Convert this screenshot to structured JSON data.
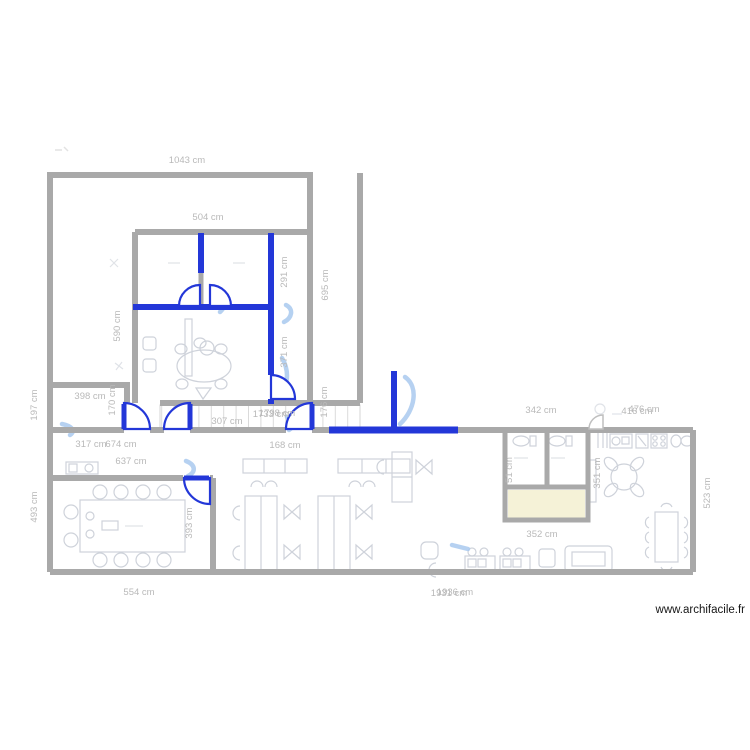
{
  "app": {
    "watermark": "www.archifacile.fr"
  },
  "plan": {
    "unit": "cm",
    "colors": {
      "wall": "#a9a9a9",
      "partition_wall": "#2337d8",
      "sketch_pen": "#a9c9ef",
      "dimension_label": "#b9b9b9",
      "furniture_stroke": "#ced2da",
      "highlight_room_fill": "#f5f2d7"
    },
    "dimensions": {
      "d1043": "1043 cm",
      "d504": "504 cm",
      "d590": "590 cm",
      "d291": "291 cm",
      "d695": "695 cm",
      "d371": "371 cm",
      "d176": "176 cm",
      "d398": "398 cm",
      "d170": "170 cm",
      "d307": "307 cm",
      "d1733": "1733 cm",
      "d1798": "1798 cm",
      "d168": "168 cm",
      "d317": "317 cm",
      "d674": "674 cm",
      "d637": "637 cm",
      "d197": "197 cm",
      "d493": "493 cm",
      "d393": "393 cm",
      "d554": "554 cm",
      "d1931": "1931 cm",
      "d1936": "1936 cm",
      "d342": "342 cm",
      "d416": "416 cm",
      "d476": "476 cm",
      "d51": "51 cm",
      "d351": "351 cm",
      "d352": "352 cm",
      "d523": "523 cm"
    }
  }
}
